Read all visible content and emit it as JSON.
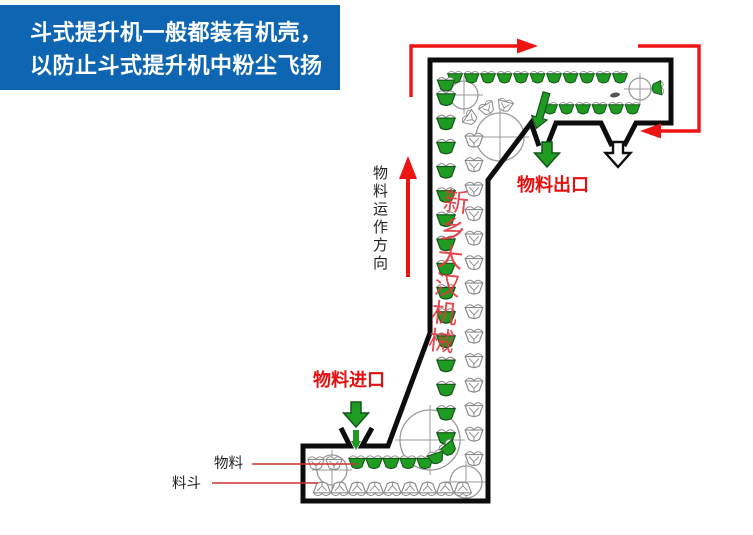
{
  "banner": {
    "line1": "斗式提升机一般都装有机壳，",
    "line2": "以防止斗式提升机中粉尘飞扬"
  },
  "diagram": {
    "labels": {
      "flow_direction": "物料运作方向",
      "outlet": "物料出口",
      "inlet": "物料进口",
      "material": "物料",
      "bucket": "料斗"
    },
    "watermark": "新乡大汉机械"
  },
  "colors": {
    "background": "#ffffff",
    "banner_blue": "#0e66b2",
    "banner_text": "#ffffff",
    "bucket_green": "#1f9b22",
    "bucket_green_dark": "#14551a",
    "arrow_red": "#ee1414",
    "label_red": "#e60f0f",
    "leader_red": "#cc3333",
    "casing_black": "#0d0d0d",
    "empty_bucket_gray": "#8a8a8a",
    "pulley_gray": "#9a9a9a",
    "watermark_red": "#e2383d",
    "text_black": "#222222"
  }
}
